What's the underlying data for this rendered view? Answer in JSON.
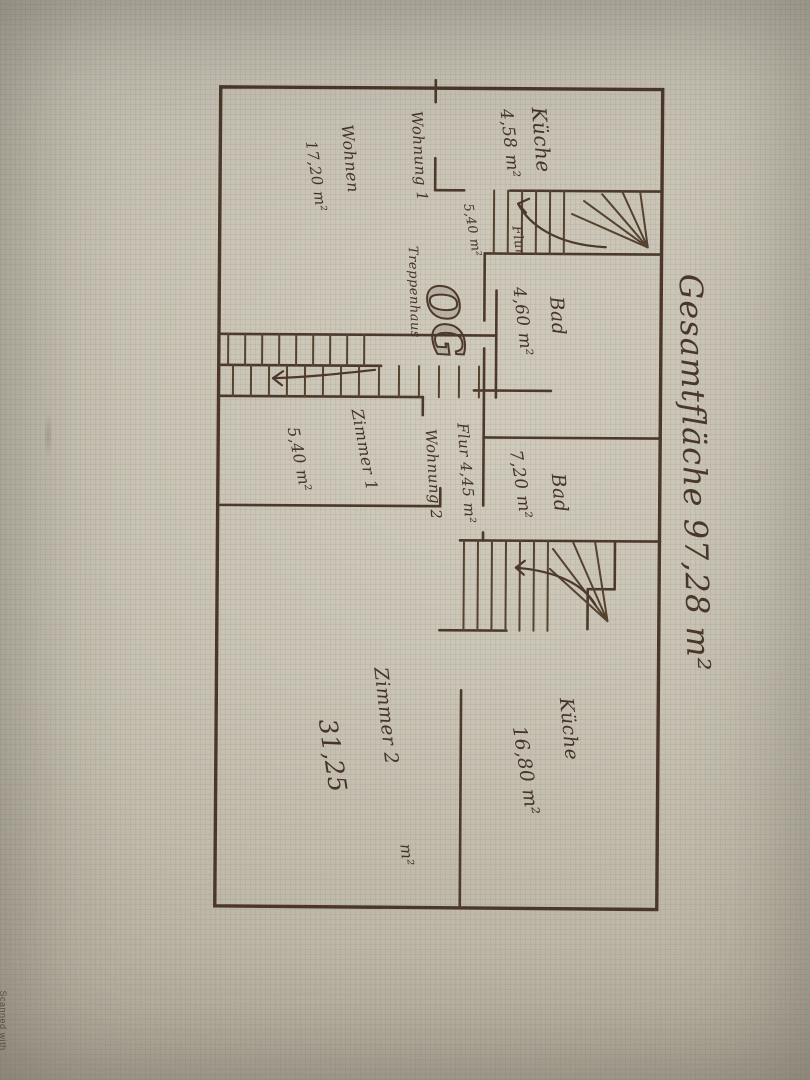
{
  "title": "Gesamtfläche 97,28 m²",
  "watermark": "Scanned with",
  "floor": "OG",
  "apartments": [
    "Wohnung 1",
    "Wohnung 2"
  ],
  "stairwell": "Treppenhaus",
  "rooms": [
    {
      "apartment": "Wohnung 1",
      "name": "Küche",
      "area": "4,58 m²"
    },
    {
      "apartment": "Wohnung 1",
      "name": "Flur",
      "area": "5,40 m²"
    },
    {
      "apartment": "Wohnung 1",
      "name": "Bad",
      "area": "4,60 m²"
    },
    {
      "apartment": "Wohnung 1",
      "name": "Wohnen",
      "area": "17,20 m²"
    },
    {
      "apartment": "Wohnung 2",
      "name": "Bad",
      "area": "7,20 m²"
    },
    {
      "apartment": "Wohnung 2",
      "name": "Flur",
      "area": "4,45 m²"
    },
    {
      "apartment": "Wohnung 2",
      "name": "Zimmer 1",
      "area": "5,40 m²"
    },
    {
      "apartment": "Wohnung 2",
      "name": "Zimmer 2",
      "area": "31,25 m²"
    },
    {
      "apartment": "Wohnung 2",
      "name": "Küche",
      "area": "16,80 m²"
    }
  ],
  "ink_color": "#4a3729",
  "paper_color": "#c4bfb0",
  "labels": [
    {
      "id": "room-kueche1-name",
      "t": "Küche",
      "x": 139,
      "y": 271,
      "s": 20,
      "r": -5
    },
    {
      "id": "room-kueche1-area",
      "t": "4,58 m²",
      "x": 143,
      "y": 303,
      "s": 17,
      "r": -7
    },
    {
      "id": "room-flur1-name",
      "t": "Flur",
      "x": 240,
      "y": 294,
      "s": 13,
      "r": -8
    },
    {
      "id": "room-flur1-area",
      "t": "5,40 m²",
      "x": 230,
      "y": 340,
      "s": 13,
      "r": -10
    },
    {
      "id": "room-bad1-name",
      "t": "Bad",
      "x": 315,
      "y": 254,
      "s": 19,
      "r": -4
    },
    {
      "id": "room-bad1-area",
      "t": "4,60 m²",
      "x": 321,
      "y": 289,
      "s": 17,
      "r": -7
    },
    {
      "id": "room-bad2-name",
      "t": "Bad",
      "x": 492,
      "y": 251,
      "s": 19,
      "r": -5
    },
    {
      "id": "room-bad2-area",
      "t": "7,20 m²",
      "x": 484,
      "y": 290,
      "s": 17,
      "r": -9
    },
    {
      "id": "floor-label",
      "t": "OG",
      "x": 322,
      "y": 366,
      "s": 42,
      "r": -8,
      "cls": "og"
    },
    {
      "id": "stairwell-label",
      "t": "Treppenhaus",
      "x": 292,
      "y": 398,
      "s": 13,
      "r": -2
    },
    {
      "id": "apartment1-label",
      "t": "Wohnung 1",
      "x": 156,
      "y": 393,
      "s": 15,
      "r": -4
    },
    {
      "id": "room-wohnen-name",
      "t": "Wohnen",
      "x": 159,
      "y": 462,
      "s": 16,
      "r": -6
    },
    {
      "id": "room-wohnen-area",
      "t": "17,20 m²",
      "x": 177,
      "y": 496,
      "s": 15,
      "r": -9
    },
    {
      "id": "room-flur2-label",
      "t": "Flur 4,45 m²",
      "x": 473,
      "y": 344,
      "s": 15,
      "r": -5
    },
    {
      "id": "apartment2-label",
      "t": "Wohnung 2",
      "x": 474,
      "y": 377,
      "s": 15,
      "r": -4
    },
    {
      "id": "room-zimmer1-name",
      "t": "Zimmer 1",
      "x": 450,
      "y": 446,
      "s": 16,
      "r": -11
    },
    {
      "id": "room-zimmer1-area",
      "t": "5,40 m²",
      "x": 460,
      "y": 511,
      "s": 16,
      "r": -12
    },
    {
      "id": "room-zimmer2-name",
      "t": "Zimmer 2",
      "x": 716,
      "y": 423,
      "s": 19,
      "r": -7
    },
    {
      "id": "room-zimmer2-unit",
      "t": "m²",
      "x": 855,
      "y": 401,
      "s": 16,
      "r": -7
    },
    {
      "id": "room-zimmer2-area",
      "t": "31,25",
      "x": 756,
      "y": 476,
      "s": 25,
      "r": -9
    },
    {
      "id": "room-kueche2-name",
      "t": "Küche",
      "x": 728,
      "y": 240,
      "s": 19,
      "r": -6
    },
    {
      "id": "room-kueche2-area",
      "t": "16,80 m²",
      "x": 770,
      "y": 283,
      "s": 19,
      "r": -9
    }
  ]
}
